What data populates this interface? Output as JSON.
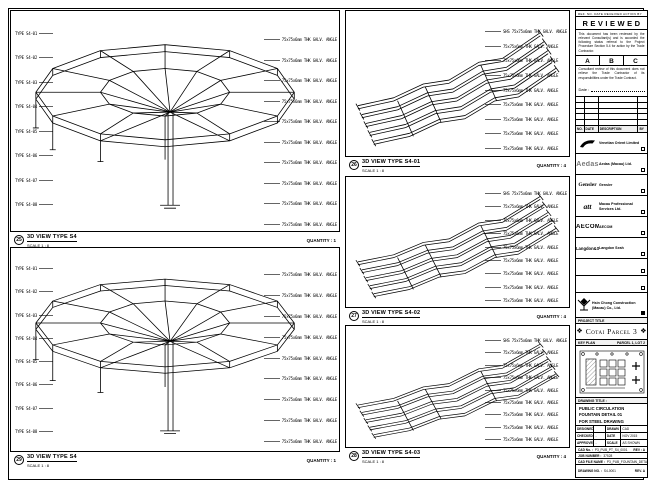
{
  "sheet": {
    "microstrip": "REF. NO.    DATE RECEIVED    ACTION    BY"
  },
  "viewports": {
    "vp1": {
      "no": "25",
      "title": "3D VIEW TYPE S4",
      "scale": "SCALE 1 : 8",
      "quantity": "QUANTITY : 1",
      "left_labels": [
        "TYPE S4-01",
        "TYPE S4-02",
        "TYPE S4-03",
        "TYPE S4-04",
        "TYPE S4-05",
        "TYPE S4-06",
        "TYPE S4-07",
        "TYPE S4-08"
      ],
      "right_labels": [
        "75x75x6mm THK GALV. ANGLE",
        "75x75x6mm THK GALV. ANGLE",
        "75x75x6mm THK GALV. ANGLE",
        "75x75x6mm THK GALV. ANGLE",
        "75x75x6mm THK GALV. ANGLE",
        "75x75x6mm THK GALV. ANGLE",
        "75x75x6mm THK GALV. ANGLE",
        "75x75x6mm THK GALV. ANGLE",
        "75x75x6mm THK GALV. ANGLE",
        "75x75x6mm THK GALV. ANGLE"
      ]
    },
    "vp2": {
      "no": "29",
      "title": "3D VIEW TYPE S4",
      "scale": "SCALE 1 : 8",
      "quantity": "QUANTITY : 1",
      "left_labels": [
        "TYPE S4-01",
        "TYPE S4-02",
        "TYPE S4-03",
        "TYPE S4-04",
        "TYPE S4-05",
        "TYPE S4-06",
        "TYPE S4-07",
        "TYPE S4-08"
      ],
      "right_labels": [
        "75x75x6mm THK GALV. ANGLE",
        "75x75x6mm THK GALV. ANGLE",
        "75x75x6mm THK GALV. ANGLE",
        "75x75x6mm THK GALV. ANGLE",
        "75x75x6mm THK GALV. ANGLE",
        "75x75x6mm THK GALV. ANGLE",
        "75x75x6mm THK GALV. ANGLE",
        "75x75x6mm THK GALV. ANGLE",
        "75x75x6mm THK GALV. ANGLE"
      ]
    },
    "vp3": {
      "no": "26",
      "title": "3D VIEW TYPE S4-01",
      "scale": "SCALE 1 : 8",
      "quantity": "QUANTITY : 4",
      "right_labels": [
        "SHS 75x75x6mm THK GALV. ANGLE",
        "75x75x6mm THK GALV. ANGLE",
        "75x75x6mm THK GALV. ANGLE",
        "75x75x6mm THK GALV. ANGLE",
        "75x75x6mm THK GALV. ANGLE",
        "75x75x6mm THK GALV. ANGLE",
        "75x75x6mm THK GALV. ANGLE",
        "75x75x6mm THK GALV. ANGLE",
        "75x75x6mm THK GALV. ANGLE"
      ]
    },
    "vp4": {
      "no": "27",
      "title": "3D VIEW TYPE S4-02",
      "scale": "SCALE 1 : 8",
      "quantity": "QUANTITY : 4",
      "right_labels": [
        "SHS 75x75x6mm THK GALV. ANGLE",
        "75x75x6mm THK GALV. ANGLE",
        "75x75x6mm THK GALV. ANGLE",
        "75x75x6mm THK GALV. ANGLE",
        "75x75x6mm THK GALV. ANGLE",
        "75x75x6mm THK GALV. ANGLE",
        "75x75x6mm THK GALV. ANGLE",
        "75x75x6mm THK GALV. ANGLE",
        "75x75x6mm THK GALV. ANGLE"
      ]
    },
    "vp5": {
      "no": "28",
      "title": "3D VIEW TYPE S4-03",
      "scale": "SCALE 1 : 8",
      "quantity": "QUANTITY : 4",
      "right_labels": [
        "SHS 75x75x6mm THK GALV. ANGLE",
        "75x75x6mm THK GALV. ANGLE",
        "75x75x6mm THK GALV. ANGLE",
        "75x75x6mm THK GALV. ANGLE",
        "75x75x6mm THK GALV. ANGLE",
        "75x75x6mm THK GALV. ANGLE",
        "75x75x6mm THK GALV. ANGLE",
        "75x75x6mm THK GALV. ANGLE",
        "75x75x6mm THK GALV. ANGLE"
      ]
    }
  },
  "stamp": {
    "title": "REVIEWED",
    "para1": "This document has been reviewed by the relevant Consultant(s) and is accorded the following status referral to the Project Procedure Section 5.4 for action by the Trade Contractor.",
    "grades": [
      "A",
      "B",
      "C"
    ],
    "para2": "Consultant review of this document does not relieve the Trade Contractor of its responsibilities under the Trade Contract.",
    "date_label": "Date :"
  },
  "revision": {
    "header": [
      "NO.",
      "DATE",
      "DESCRIPTION",
      "BY"
    ]
  },
  "consultants": [
    {
      "name": "Venetian Orient Limited"
    },
    {
      "name": "Aedas (Macau) Ltd.",
      "logo_text": "Aedas"
    },
    {
      "name": "Gensler",
      "logo_text": "Gensler"
    },
    {
      "name": "Macau Professional Services Ltd.",
      "logo_text": "att"
    },
    {
      "name": "AECOM",
      "logo_text": "AECOM"
    },
    {
      "name": "Langdon Seah",
      "logo_text": "Langdon&Seah"
    }
  ],
  "contractor": {
    "name": "Hsin Chong Construction (Macau) Co., Ltd."
  },
  "project": {
    "band": "PROJECT TITLE",
    "name": "Cotai Parcel 3",
    "emblem": "❖"
  },
  "key_plan": {
    "band_left": "KEY PLAN",
    "band_right": "PARCEL 1, LOT 2"
  },
  "drawing_title": {
    "band": "DRAWING TITLE :",
    "line1": "PUBLIC CIRCULATION",
    "line2": "FOUNTAIN DETAIL 01",
    "line3": "FOR STEEL DRAWING"
  },
  "approvals": {
    "r1l": "DESIGNED",
    "r1v": "",
    "r1r": "DRAWN",
    "r1rv": "CAD",
    "r2l": "CHECKED",
    "r2v": "-",
    "r2r": "DATE",
    "r2rv": "NOV 2015",
    "r3l": "APPROVED",
    "r3v": "-",
    "r3r": "SCALE",
    "r3rv": "AS SHOWN"
  },
  "footer": {
    "cad_label": "CAD No. :",
    "cad_value": "P3_PUB_PT_S4_0001",
    "cad_rev": "REV : A",
    "job_label": "JOB NUMBER :",
    "job_value": "37528",
    "file_label": "CAD FILE NAME :",
    "file_value": "P3_PUB_FOUNTAIN_DETAIL_S4.dwg",
    "dwg_label": "DRAWING NO. :",
    "dwg_value": "S4-0001",
    "dwg_rev": "REV. A"
  }
}
